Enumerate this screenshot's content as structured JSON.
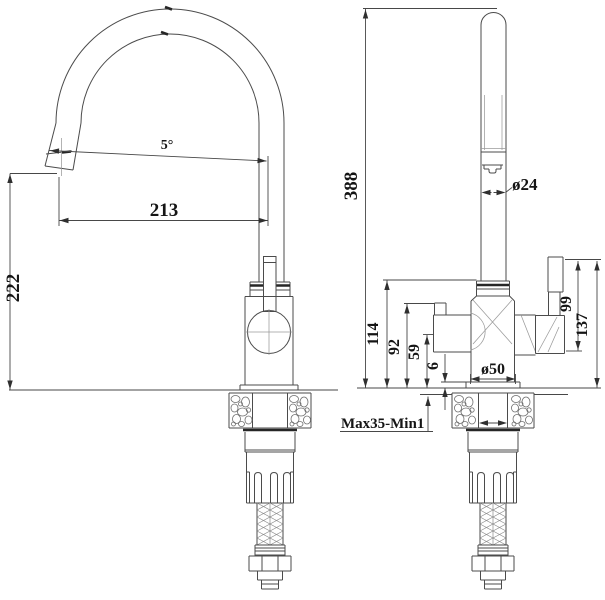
{
  "drawing": {
    "type": "faucet-dimensional-drawing",
    "views": [
      "side-view",
      "front-view"
    ]
  },
  "labels": {
    "left": {
      "angle": "5°",
      "reach": "213",
      "spout_height": "222"
    },
    "right": {
      "total_height": "388",
      "spout_diameter": "ø24",
      "body_height": "114",
      "outlet_height": "92",
      "side_outlet_height": "59",
      "base_gap": "6",
      "base_diameter": "ø50",
      "handle_height": "99",
      "handle_total_height": "137",
      "mounting_range": "Max35-Min1"
    }
  },
  "colors": {
    "background": "#ffffff",
    "line": "#4b4b4b",
    "dark_band": "#262626",
    "text": "#151515"
  }
}
